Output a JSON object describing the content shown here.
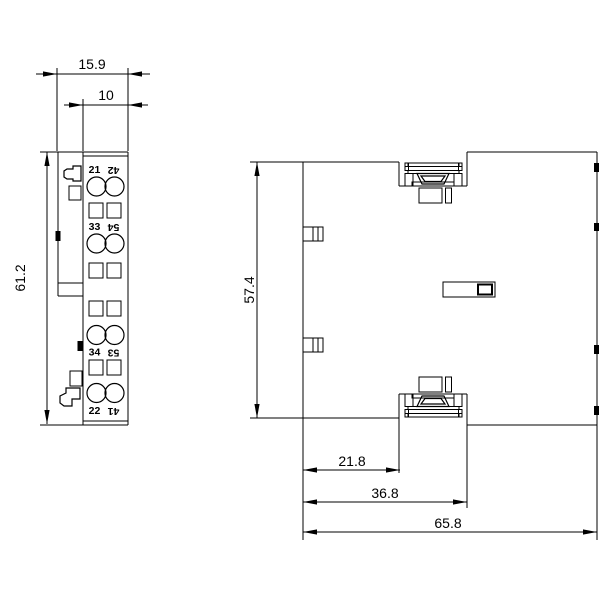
{
  "drawing_type": "technical-dimension-drawing",
  "views": {
    "front": {
      "dimensions": {
        "total_width": "15.9",
        "terminal_width": "10",
        "height": "61.2"
      },
      "terminal_labels": {
        "row1_left": "21",
        "row1_right": "42",
        "row2_left": "33",
        "row2_right": "54",
        "row3_left": "34",
        "row3_right": "53",
        "row4_left": "22",
        "row4_right": "41"
      }
    },
    "side": {
      "dimensions": {
        "height": "57.4",
        "foot_offset": "21.8",
        "foot_depth": "36.8",
        "total_depth": "65.8"
      }
    }
  },
  "colors": {
    "line": "#000000",
    "background": "#ffffff"
  }
}
